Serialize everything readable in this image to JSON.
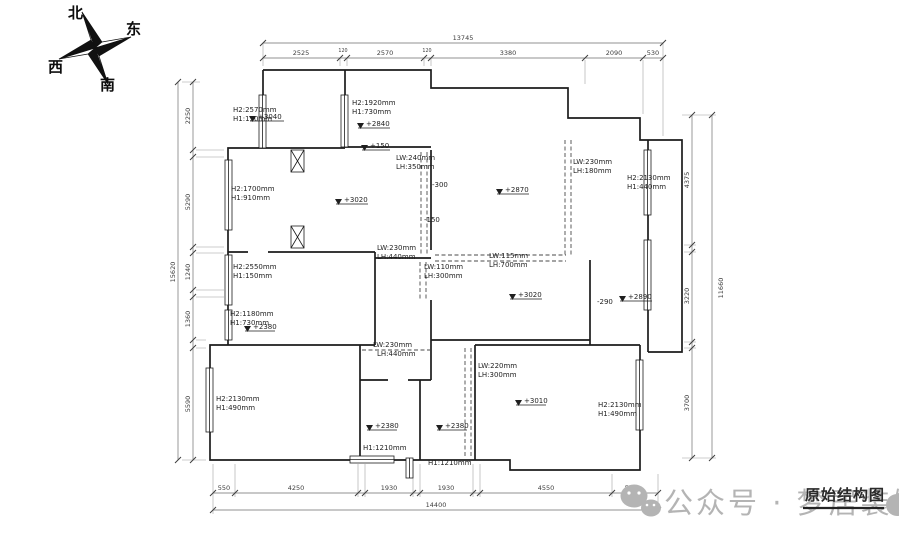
{
  "meta": {
    "drawing_title": "原始结构图",
    "watermark_text": "公众号 · 梦居装饰"
  },
  "compass": {
    "north": "北",
    "east": "东",
    "west": "西",
    "south": "南"
  },
  "dims": {
    "top": {
      "total": "13745",
      "segs": [
        "2525",
        "120",
        "2570",
        "120",
        "3380",
        "2090",
        "530"
      ]
    },
    "bottom": {
      "total": "14400",
      "segs": [
        "550",
        "4250",
        "1930",
        "1930",
        "4550",
        "550"
      ]
    },
    "left": {
      "total": "15620",
      "segs": [
        "2250",
        "5290",
        "1240",
        "1360",
        "5590"
      ]
    },
    "right": {
      "total": "11660",
      "segs": [
        "4375",
        "3220",
        "3700"
      ]
    }
  },
  "annotations": [
    {
      "t": "H2:2570mm"
    },
    {
      "t": "H1:130mm"
    },
    {
      "t": "+3040"
    },
    {
      "t": "H2:1920mm"
    },
    {
      "t": "H1:730mm"
    },
    {
      "t": "+2840"
    },
    {
      "t": "+150"
    },
    {
      "t": "H2:1700mm"
    },
    {
      "t": "H1:910mm"
    },
    {
      "t": "+3020"
    },
    {
      "t": "LW:240mm"
    },
    {
      "t": "LH:350mm"
    },
    {
      "t": "-300"
    },
    {
      "t": "-150"
    },
    {
      "t": "+2870"
    },
    {
      "t": "LW:230mm"
    },
    {
      "t": "LH:180mm"
    },
    {
      "t": "H2:2130mm"
    },
    {
      "t": "H1:440mm"
    },
    {
      "t": "H2:2550mm"
    },
    {
      "t": "H1:150mm"
    },
    {
      "t": "LW:230mm"
    },
    {
      "t": "LH:440mm"
    },
    {
      "t": "LW:110mm"
    },
    {
      "t": "LH:300mm"
    },
    {
      "t": "LW:115mm"
    },
    {
      "t": "LH:700mm"
    },
    {
      "t": "+3020"
    },
    {
      "t": "-290"
    },
    {
      "t": "+2890"
    },
    {
      "t": "H2:1180mm"
    },
    {
      "t": "H1:730mm"
    },
    {
      "t": "+2380"
    },
    {
      "t": "LW:230mm"
    },
    {
      "t": "LH:440mm"
    },
    {
      "t": "LW:220mm"
    },
    {
      "t": "LH:300mm"
    },
    {
      "t": "H2:2130mm"
    },
    {
      "t": "H1:490mm"
    },
    {
      "t": "+3010"
    },
    {
      "t": "H2:2130mm"
    },
    {
      "t": "H1:490mm"
    },
    {
      "t": "+2380"
    },
    {
      "t": "+2380"
    },
    {
      "t": "H1:1210mm"
    },
    {
      "t": "H1:1210mm"
    }
  ]
}
